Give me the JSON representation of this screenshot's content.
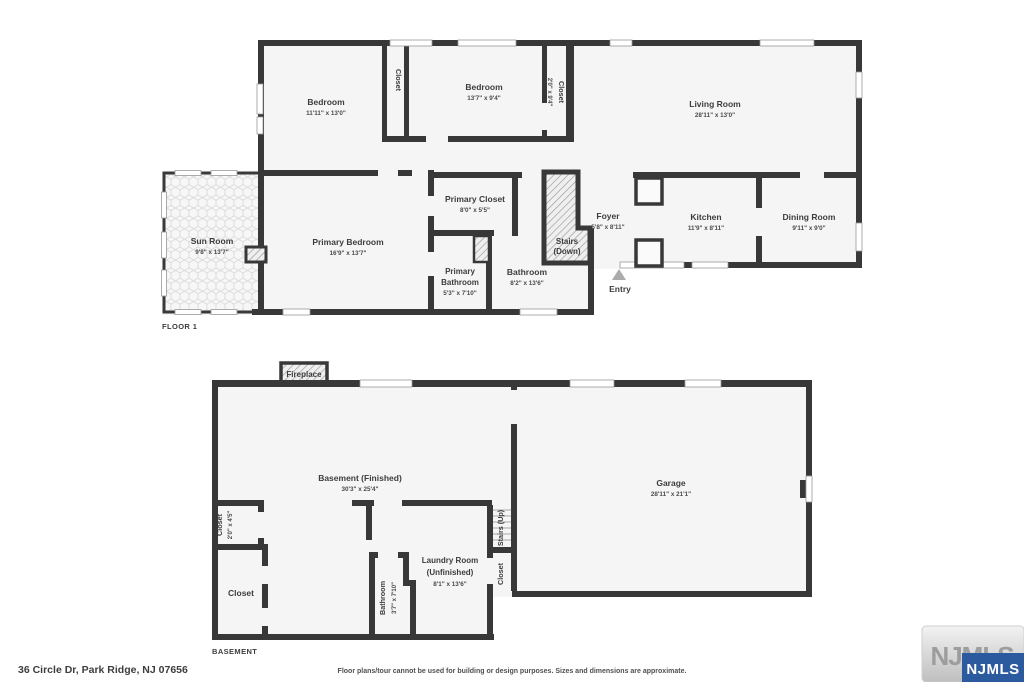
{
  "page": {
    "floor1_label": "FLOOR 1",
    "basement_label": "BASEMENT",
    "address": "36 Circle Dr, Park Ridge, NJ 07656",
    "disclaimer": "Floor plans/tour cannot be used for building or design purposes. Sizes and dimensions are approximate."
  },
  "logo": {
    "watermark": "NJMLS",
    "badge": "NJMLS"
  },
  "floor1": {
    "bedroom_left": {
      "name": "Bedroom",
      "dims": "11'11\" x 13'0\""
    },
    "closet_left": {
      "name": "Closet"
    },
    "bedroom_mid": {
      "name": "Bedroom",
      "dims": "13'7\" x 9'4\""
    },
    "closet_mid": {
      "name": "Closet",
      "dims": "2'0\" x 9'4\""
    },
    "living_room": {
      "name": "Living Room",
      "dims": "28'11\" x 13'0\""
    },
    "primary_closet": {
      "name": "Primary Closet",
      "dims": "8'0\" x 5'5\""
    },
    "foyer": {
      "name": "Foyer",
      "dims": "5'8\" x 8'11\""
    },
    "kitchen": {
      "name": "Kitchen",
      "dims": "11'9\" x 8'11\""
    },
    "dining_room": {
      "name": "Dining Room",
      "dims": "9'11\" x 9'0\""
    },
    "sun_room": {
      "name": "Sun Room",
      "dims": "9'8\" x 13'7\""
    },
    "primary_bedroom": {
      "name": "Primary Bedroom",
      "dims": "16'9\" x 13'7\""
    },
    "primary_bathroom": {
      "line1": "Primary",
      "line2": "Bathroom",
      "dims": "5'3\" x 7'10\""
    },
    "bathroom": {
      "name": "Bathroom",
      "dims": "8'2\" x 13'6\""
    },
    "stairs": {
      "line1": "Stairs",
      "line2": "(Down)"
    },
    "entry": {
      "name": "Entry"
    }
  },
  "basement": {
    "fireplace": {
      "name": "Fireplace"
    },
    "finished": {
      "name": "Basement (Finished)",
      "dims": "30'3\" x 25'4\""
    },
    "closet_top_left": {
      "name": "Closet",
      "dims": "2'0\" x 4'5\""
    },
    "closet_bottom_left": {
      "name": "Closet"
    },
    "bathroom": {
      "name": "Bathroom",
      "dims": "3'7\" x 7'10\""
    },
    "laundry": {
      "line1": "Laundry Room",
      "line2": "(Unfinished)",
      "dims": "8'1\" x 13'6\""
    },
    "stairs_up": {
      "name": "Stairs (Up)"
    },
    "closet_right": {
      "name": "Closet"
    },
    "garage": {
      "name": "Garage",
      "dims": "28'11\" x 21'1\""
    }
  }
}
